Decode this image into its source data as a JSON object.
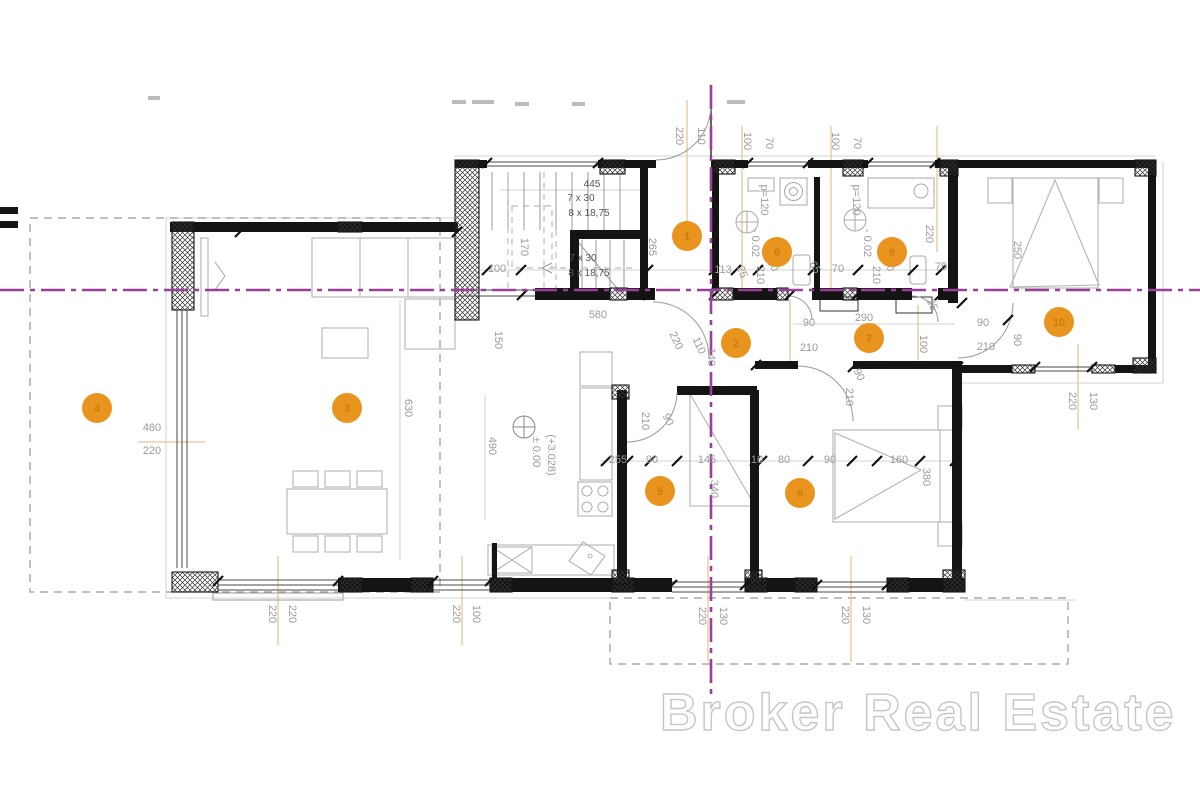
{
  "watermark": {
    "text": "Broker Real Estate"
  },
  "colors": {
    "axis": "#9b3f9b",
    "marker_fill": "#e8941f",
    "marker_number": "#c07a12",
    "wall": "#141414",
    "dim_text": "#9b9b9b",
    "leader": "#e7c795"
  },
  "plan": {
    "labels": [
      {
        "t": "220",
        "x": 676,
        "y": 136,
        "r": 90
      },
      {
        "t": "110",
        "x": 698,
        "y": 136,
        "r": 90
      },
      {
        "t": "100",
        "x": 744,
        "y": 141,
        "r": 90
      },
      {
        "t": "70",
        "x": 766,
        "y": 143,
        "r": 90
      },
      {
        "t": "100",
        "x": 832,
        "y": 141,
        "r": 90
      },
      {
        "t": "70",
        "x": 854,
        "y": 143,
        "r": 90
      },
      {
        "t": "445",
        "x": 592,
        "y": 187,
        "r": 0,
        "c": "dark"
      },
      {
        "t": "7 x 30",
        "x": 581,
        "y": 201,
        "r": 0,
        "c": "dark"
      },
      {
        "t": "8 x 18,75",
        "x": 589,
        "y": 216,
        "r": 0,
        "c": "dark"
      },
      {
        "t": "7 x 30",
        "x": 583,
        "y": 261,
        "r": 0,
        "c": "dark"
      },
      {
        "t": "8 x 18,75",
        "x": 589,
        "y": 276,
        "r": 0,
        "c": "dark"
      },
      {
        "t": "170",
        "x": 521,
        "y": 247,
        "r": 90
      },
      {
        "t": "265",
        "x": 649,
        "y": 247,
        "r": 90
      },
      {
        "t": "100",
        "x": 497,
        "y": 272,
        "r": 0
      },
      {
        "t": "113",
        "x": 723,
        "y": 273,
        "r": 0
      },
      {
        "t": "25",
        "x": 739,
        "y": 273,
        "r": 70
      },
      {
        "t": "p=120",
        "x": 761,
        "y": 200,
        "r": 90
      },
      {
        "t": "- 0.02",
        "x": 752,
        "y": 243,
        "r": 90
      },
      {
        "t": "p=120",
        "x": 853,
        "y": 200,
        "r": 90
      },
      {
        "t": "- 0.02",
        "x": 864,
        "y": 243,
        "r": 90
      },
      {
        "t": "65",
        "x": 812,
        "y": 269,
        "r": 60
      },
      {
        "t": "80",
        "x": 770,
        "y": 267,
        "r": 60
      },
      {
        "t": "210",
        "x": 757,
        "y": 275,
        "r": 90
      },
      {
        "t": "70",
        "x": 838,
        "y": 272,
        "r": 0
      },
      {
        "t": "80",
        "x": 886,
        "y": 267,
        "r": 60
      },
      {
        "t": "210",
        "x": 873,
        "y": 275,
        "r": 90
      },
      {
        "t": "75",
        "x": 941,
        "y": 270,
        "r": 0
      },
      {
        "t": "220",
        "x": 926,
        "y": 234,
        "r": 90
      },
      {
        "t": "250",
        "x": 1014,
        "y": 250,
        "r": 90
      },
      {
        "t": "580",
        "x": 598,
        "y": 318,
        "r": 0
      },
      {
        "t": "220",
        "x": 673,
        "y": 342,
        "r": 65
      },
      {
        "t": "110",
        "x": 696,
        "y": 347,
        "r": 65
      },
      {
        "t": "140",
        "x": 708,
        "y": 357,
        "r": 90
      },
      {
        "t": "90",
        "x": 809,
        "y": 326,
        "r": 0
      },
      {
        "t": "290",
        "x": 864,
        "y": 321,
        "r": 0
      },
      {
        "t": "210",
        "x": 809,
        "y": 351,
        "r": 0
      },
      {
        "t": "25",
        "x": 929,
        "y": 306,
        "r": 65
      },
      {
        "t": "100",
        "x": 920,
        "y": 344,
        "r": 90
      },
      {
        "t": "90",
        "x": 1014,
        "y": 340,
        "r": 90
      },
      {
        "t": "90",
        "x": 983,
        "y": 326,
        "r": 0
      },
      {
        "t": "210",
        "x": 986,
        "y": 350,
        "r": 0
      },
      {
        "t": "150",
        "x": 495,
        "y": 340,
        "r": 90
      },
      {
        "t": "630",
        "x": 405,
        "y": 408,
        "r": 90
      },
      {
        "t": "490",
        "x": 489,
        "y": 446,
        "r": 90
      },
      {
        "t": "480",
        "x": 152,
        "y": 431,
        "r": 0
      },
      {
        "t": "220",
        "x": 152,
        "y": 454,
        "r": 0
      },
      {
        "t": "± 0.00",
        "x": 533,
        "y": 452,
        "r": 90
      },
      {
        "t": "(+3.028)",
        "x": 548,
        "y": 455,
        "r": 90
      },
      {
        "t": "210",
        "x": 642,
        "y": 421,
        "r": 90
      },
      {
        "t": "90",
        "x": 665,
        "y": 421,
        "r": 65
      },
      {
        "t": "210",
        "x": 846,
        "y": 397,
        "r": 90
      },
      {
        "t": "90",
        "x": 856,
        "y": 376,
        "r": 65
      },
      {
        "t": "255",
        "x": 618,
        "y": 463,
        "r": 0
      },
      {
        "t": "90",
        "x": 652,
        "y": 463,
        "r": 0
      },
      {
        "t": "145",
        "x": 707,
        "y": 463,
        "r": 0
      },
      {
        "t": "10",
        "x": 757,
        "y": 463,
        "r": 0
      },
      {
        "t": "80",
        "x": 784,
        "y": 463,
        "r": 0
      },
      {
        "t": "90",
        "x": 830,
        "y": 463,
        "r": 0
      },
      {
        "t": "160",
        "x": 899,
        "y": 463,
        "r": 0
      },
      {
        "t": "380",
        "x": 923,
        "y": 477,
        "r": 90
      },
      {
        "t": "340",
        "x": 711,
        "y": 489,
        "r": 90
      },
      {
        "t": "220",
        "x": 269,
        "y": 614,
        "r": 90
      },
      {
        "t": "220",
        "x": 289,
        "y": 614,
        "r": 90
      },
      {
        "t": "220",
        "x": 453,
        "y": 614,
        "r": 90
      },
      {
        "t": "100",
        "x": 473,
        "y": 614,
        "r": 90
      },
      {
        "t": "220",
        "x": 699,
        "y": 616,
        "r": 90
      },
      {
        "t": "130",
        "x": 720,
        "y": 616,
        "r": 90
      },
      {
        "t": "220",
        "x": 842,
        "y": 615,
        "r": 90
      },
      {
        "t": "130",
        "x": 863,
        "y": 615,
        "r": 90
      },
      {
        "t": "220",
        "x": 1069,
        "y": 401,
        "r": 90
      },
      {
        "t": "130",
        "x": 1090,
        "y": 401,
        "r": 90
      }
    ],
    "markers": [
      {
        "n": "1",
        "x": 687,
        "y": 236
      },
      {
        "n": "2",
        "x": 736,
        "y": 343
      },
      {
        "n": "3",
        "x": 347,
        "y": 408
      },
      {
        "n": "4",
        "x": 97,
        "y": 408
      },
      {
        "n": "5",
        "x": 660,
        "y": 491
      },
      {
        "n": "6",
        "x": 777,
        "y": 252
      },
      {
        "n": "7",
        "x": 869,
        "y": 338
      },
      {
        "n": "8",
        "x": 800,
        "y": 493
      },
      {
        "n": "9",
        "x": 892,
        "y": 252
      },
      {
        "n": "10",
        "x": 1059,
        "y": 322
      }
    ]
  }
}
